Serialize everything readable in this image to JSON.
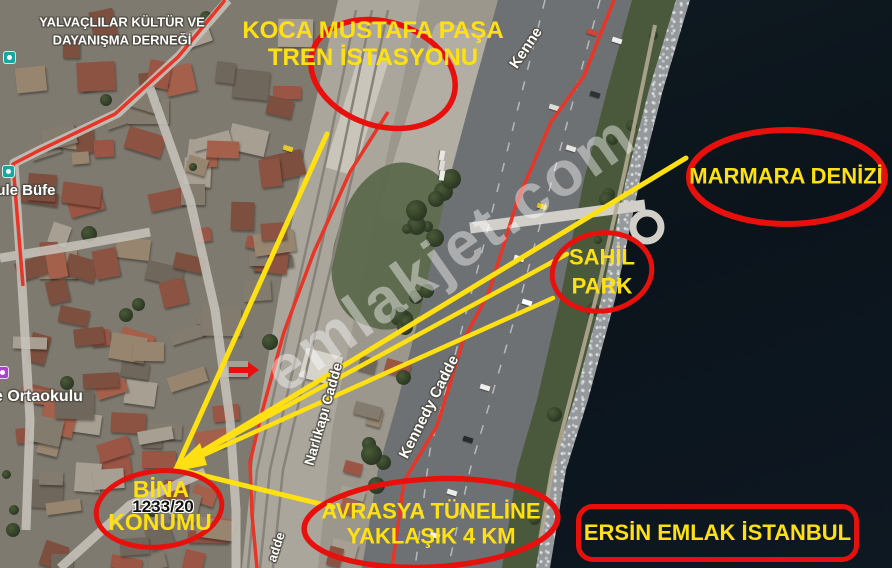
{
  "map": {
    "watermark": "emlakjet.com",
    "labels": {
      "association_line1": "YALVAÇLILAR KÜLTÜR VE",
      "association_line2": "DAYANIŞMA DERNEĞİ",
      "bufe": "kule Büfe",
      "school": "e Ortaokulu",
      "kennedy_top": "Kenne",
      "kennedy": "Kennedy Cadde",
      "narlikapi": "Narlıkapı Cadde",
      "cadde_fragment": "adde"
    }
  },
  "annotations": {
    "station_line1": "KOCA MUSTAFA PAŞA",
    "station_line2": "TREN İSTASYONU",
    "marmara": "MARMARA DENİZİ",
    "sahil_line1": "SAHİL",
    "sahil_line2": "PARK",
    "bina_line1": "BİNA",
    "bina_line2": "KONUMU",
    "parcel": "1233/20",
    "avrasya_line1": "AVRASYA TÜNELİNE",
    "avrasya_line2": "YAKLAŞIK 4 KM",
    "agency": "ERSİN EMLAK İSTANBUL"
  },
  "colors": {
    "annotation_red": "#e8100c",
    "annotation_yellow": "#ffe012",
    "route_red": "#e73527",
    "sea": "#0d1720"
  }
}
